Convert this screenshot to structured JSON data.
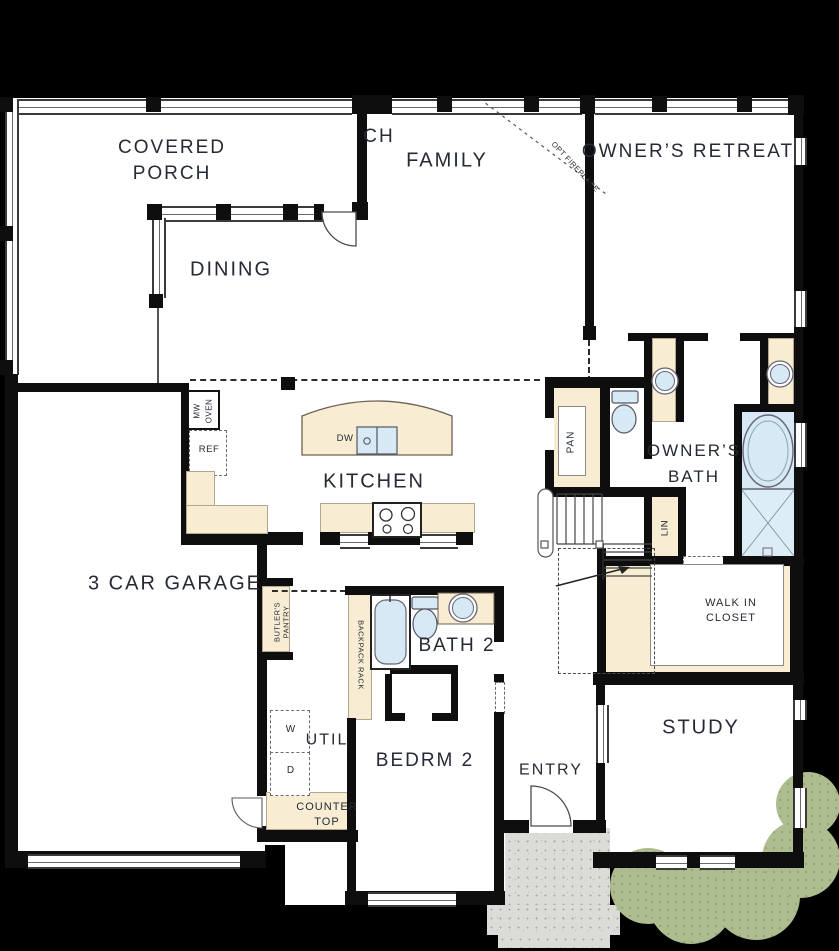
{
  "title": "First floor plan",
  "colors": {
    "bg": "#000000",
    "floor": "#ffffff",
    "wall": "#0e0e0e",
    "cream": "#f8ecd2",
    "fixture_blue": "#d6e9f4",
    "shower_blue": "#dcedf6",
    "shrub_green": "#aebd8f",
    "stoop_gray": "#dbdbd7",
    "text": "#252a35",
    "line": "#555555"
  },
  "labels": {
    "covered_porch_1": "COVERED",
    "covered_porch_2": "PORCH",
    "porch_fragment": "CH",
    "family": "FAMILY",
    "opt_fireplace": "OPT FIREPLACE",
    "owners_retreat": "OWNER’S RETREAT",
    "dining": "DINING",
    "mw": "MW",
    "oven": "OVEN",
    "ref": "REF",
    "dw": "DW",
    "kitchen": "KITCHEN",
    "pan": "PAN",
    "owners_bath_1": "OWNER’S",
    "owners_bath_2": "BATH",
    "lin": "LIN",
    "garage": "3 CAR GARAGE",
    "butlers_1": "BUTLER'S",
    "butlers_2": "PANTRY",
    "backpack": "BACKPACK RACK",
    "bath2": "BATH 2",
    "walkin_1": "WALK IN",
    "walkin_2": "CLOSET",
    "washer": "W",
    "dryer": "D",
    "util": "UTIL",
    "bedrm2": "BEDRM 2",
    "study": "STUDY",
    "entry": "ENTRY",
    "counter_1": "COUNTER",
    "counter_2": "TOP"
  }
}
